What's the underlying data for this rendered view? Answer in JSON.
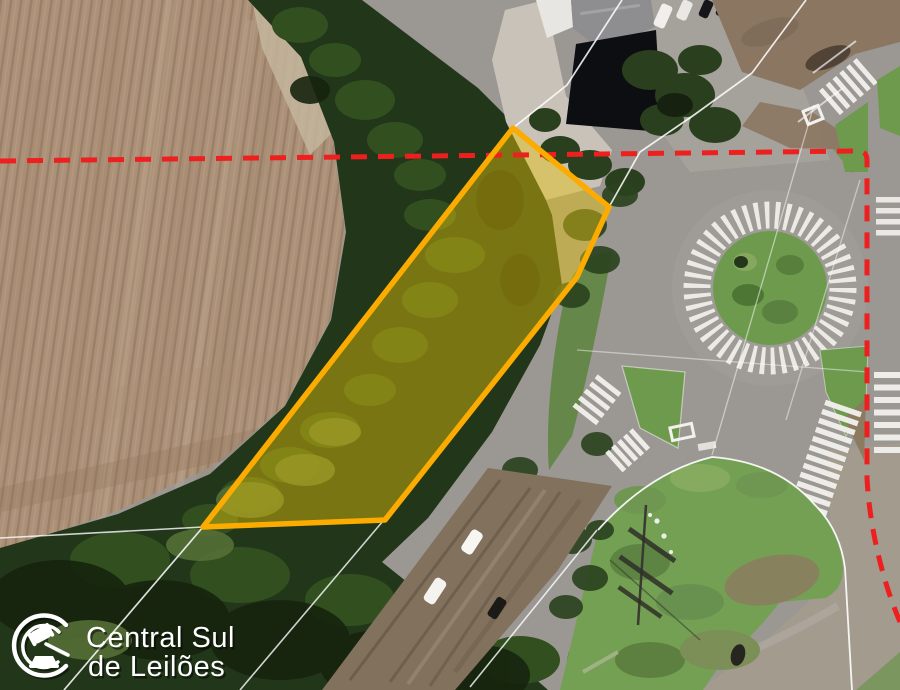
{
  "watermark": {
    "line1": "Central Sul",
    "line2": "de Leilões",
    "icon": "gavel-auction-icon",
    "text_color": "#ffffff"
  },
  "map_overlays": {
    "parcel_highlight": {
      "shape": "polygon",
      "fill_color": "#e7c40c",
      "fill_opacity": "45%",
      "stroke_color": "#fcab00"
    },
    "boundary_line": {
      "style": "dashed",
      "color": "#ee1f1f"
    },
    "cadastral_lines": {
      "style": "solid",
      "color": "#ffffff"
    }
  },
  "scene": {
    "type": "aerial-satellite-photo",
    "features": [
      "plowed-farm-field",
      "tree-line",
      "highlighted-auction-parcel",
      "roundabout-with-zebra-apron",
      "zebra-crosswalks",
      "grass-islands",
      "dirt-road",
      "white-vehicles",
      "buildings",
      "power-line-tower"
    ]
  }
}
